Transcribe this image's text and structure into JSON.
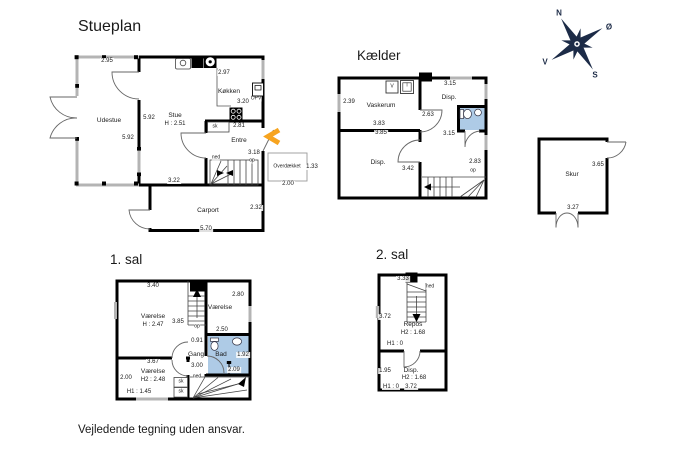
{
  "disclaimer": "Vejledende tegning uden ansvar.",
  "compass": {
    "north": "N",
    "east": "Ø",
    "south": "S",
    "west": "V"
  },
  "colors": {
    "wall": "#000000",
    "window": "#b4b4b4",
    "bathroom_fill": "#aecbe6",
    "entrance_arrow": "#f7a41f",
    "compass": "#1c2b47"
  },
  "plans": {
    "stueplan": {
      "title": "Stueplan",
      "labels": [
        {
          "text": "2.95",
          "x": 107,
          "y": 61,
          "kind": "dim"
        },
        {
          "text": "Udestue",
          "x": 109,
          "y": 121,
          "kind": "room"
        },
        {
          "text": "5.92",
          "x": 149,
          "y": 118,
          "kind": "dim"
        },
        {
          "text": "5.92",
          "x": 128,
          "y": 138,
          "kind": "dim"
        },
        {
          "text": "Stue",
          "x": 175,
          "y": 116,
          "kind": "room"
        },
        {
          "text": "H : 2.51",
          "x": 175,
          "y": 124,
          "kind": "dim"
        },
        {
          "text": "2.97",
          "x": 224,
          "y": 73,
          "kind": "dim"
        },
        {
          "text": "Køkken",
          "x": 229,
          "y": 92,
          "kind": "room"
        },
        {
          "text": "3.20",
          "x": 243,
          "y": 102,
          "kind": "dim"
        },
        {
          "text": "OPV",
          "x": 256,
          "y": 99,
          "kind": "tiny"
        },
        {
          "text": "sk",
          "x": 215,
          "y": 127,
          "kind": "tiny"
        },
        {
          "text": "2.81",
          "x": 239,
          "y": 126,
          "kind": "dim"
        },
        {
          "text": "Entre",
          "x": 239,
          "y": 141,
          "kind": "room"
        },
        {
          "text": "3.18",
          "x": 254,
          "y": 153,
          "kind": "dim"
        },
        {
          "text": "op",
          "x": 252,
          "y": 161,
          "kind": "tiny"
        },
        {
          "text": "ned",
          "x": 216,
          "y": 158,
          "kind": "tiny"
        },
        {
          "text": "3.22",
          "x": 174,
          "y": 181,
          "kind": "dim"
        },
        {
          "text": "Carport",
          "x": 208,
          "y": 211,
          "kind": "room"
        },
        {
          "text": "2.32",
          "x": 256,
          "y": 208,
          "kind": "dim"
        },
        {
          "text": "5.70",
          "x": 206,
          "y": 229,
          "kind": "dim"
        },
        {
          "text": "Overdækket",
          "x": 287,
          "y": 167,
          "kind": "tiny"
        },
        {
          "text": "1.33",
          "x": 312,
          "y": 167,
          "kind": "dim"
        },
        {
          "text": "2.00",
          "x": 288,
          "y": 184,
          "kind": "dim"
        }
      ]
    },
    "kaelder": {
      "title": "Kælder",
      "labels": [
        {
          "text": "2.39",
          "x": 349,
          "y": 102,
          "kind": "dim"
        },
        {
          "text": "Vaskerum",
          "x": 381,
          "y": 106,
          "kind": "room"
        },
        {
          "text": "3.83",
          "x": 379,
          "y": 124,
          "kind": "dim"
        },
        {
          "text": "3.85",
          "x": 381,
          "y": 133,
          "kind": "dim"
        },
        {
          "text": "3.15",
          "x": 450,
          "y": 84,
          "kind": "dim"
        },
        {
          "text": "Disp.",
          "x": 449,
          "y": 98,
          "kind": "room"
        },
        {
          "text": "2.63",
          "x": 428,
          "y": 115,
          "kind": "dim"
        },
        {
          "text": "3.15",
          "x": 449,
          "y": 134,
          "kind": "dim"
        },
        {
          "text": "Disp.",
          "x": 378,
          "y": 163,
          "kind": "room"
        },
        {
          "text": "3.42",
          "x": 408,
          "y": 169,
          "kind": "dim"
        },
        {
          "text": "2.83",
          "x": 475,
          "y": 162,
          "kind": "dim"
        },
        {
          "text": "op",
          "x": 473,
          "y": 171,
          "kind": "tiny"
        },
        {
          "text": "V",
          "x": 392,
          "y": 87,
          "kind": "tiny"
        },
        {
          "text": "T",
          "x": 407,
          "y": 86,
          "kind": "tiny"
        }
      ]
    },
    "sal1": {
      "title": "1. sal",
      "labels": [
        {
          "text": "3.40",
          "x": 153,
          "y": 286,
          "kind": "dim"
        },
        {
          "text": "2.80",
          "x": 238,
          "y": 295,
          "kind": "dim"
        },
        {
          "text": "Værelse",
          "x": 220,
          "y": 308,
          "kind": "room"
        },
        {
          "text": "Værelse",
          "x": 153,
          "y": 317,
          "kind": "room"
        },
        {
          "text": "H : 2.47",
          "x": 153,
          "y": 325,
          "kind": "dim"
        },
        {
          "text": "3.85",
          "x": 178,
          "y": 322,
          "kind": "dim"
        },
        {
          "text": "op",
          "x": 197,
          "y": 327,
          "kind": "tiny"
        },
        {
          "text": "2.50",
          "x": 222,
          "y": 330,
          "kind": "dim"
        },
        {
          "text": "0.91",
          "x": 197,
          "y": 341,
          "kind": "dim"
        },
        {
          "text": "Gang",
          "x": 196,
          "y": 355,
          "kind": "room"
        },
        {
          "text": "Bad",
          "x": 221,
          "y": 355,
          "kind": "room"
        },
        {
          "text": "1.92",
          "x": 243,
          "y": 355,
          "kind": "dim"
        },
        {
          "text": "3.00",
          "x": 197,
          "y": 366,
          "kind": "dim"
        },
        {
          "text": "2.09",
          "x": 234,
          "y": 370,
          "kind": "dim"
        },
        {
          "text": "ned",
          "x": 197,
          "y": 377,
          "kind": "tiny"
        },
        {
          "text": "3.67",
          "x": 153,
          "y": 362,
          "kind": "dim"
        },
        {
          "text": "2.00",
          "x": 126,
          "y": 378,
          "kind": "dim"
        },
        {
          "text": "Værelse",
          "x": 153,
          "y": 372,
          "kind": "room"
        },
        {
          "text": "H2 : 2.48",
          "x": 153,
          "y": 380,
          "kind": "dim"
        },
        {
          "text": "H1 : 1.45",
          "x": 139,
          "y": 392,
          "kind": "dim"
        },
        {
          "text": "sk",
          "x": 181,
          "y": 382,
          "kind": "tiny"
        },
        {
          "text": "sk",
          "x": 181,
          "y": 392,
          "kind": "tiny"
        }
      ]
    },
    "sal2": {
      "title": "2. sal",
      "labels": [
        {
          "text": "3.33",
          "x": 403,
          "y": 279,
          "kind": "dim"
        },
        {
          "text": "ned",
          "x": 430,
          "y": 287,
          "kind": "tiny"
        },
        {
          "text": "3.72",
          "x": 385,
          "y": 317,
          "kind": "dim"
        },
        {
          "text": "Repos",
          "x": 413,
          "y": 325,
          "kind": "room"
        },
        {
          "text": "H2 : 1.68",
          "x": 413,
          "y": 333,
          "kind": "dim"
        },
        {
          "text": "H1 : 0",
          "x": 395,
          "y": 344,
          "kind": "dim"
        },
        {
          "text": "1.95",
          "x": 385,
          "y": 371,
          "kind": "dim"
        },
        {
          "text": "Disp.",
          "x": 411,
          "y": 371,
          "kind": "room"
        },
        {
          "text": "H2 : 1.68",
          "x": 414,
          "y": 378,
          "kind": "dim"
        },
        {
          "text": "H1 : 0",
          "x": 391,
          "y": 387,
          "kind": "dim"
        },
        {
          "text": "3.72",
          "x": 411,
          "y": 387,
          "kind": "dim"
        }
      ]
    },
    "skur": {
      "title": "",
      "labels": [
        {
          "text": "3.65",
          "x": 598,
          "y": 165,
          "kind": "dim"
        },
        {
          "text": "Skur",
          "x": 572,
          "y": 175,
          "kind": "room"
        },
        {
          "text": "3.27",
          "x": 573,
          "y": 208,
          "kind": "dim"
        }
      ]
    }
  }
}
